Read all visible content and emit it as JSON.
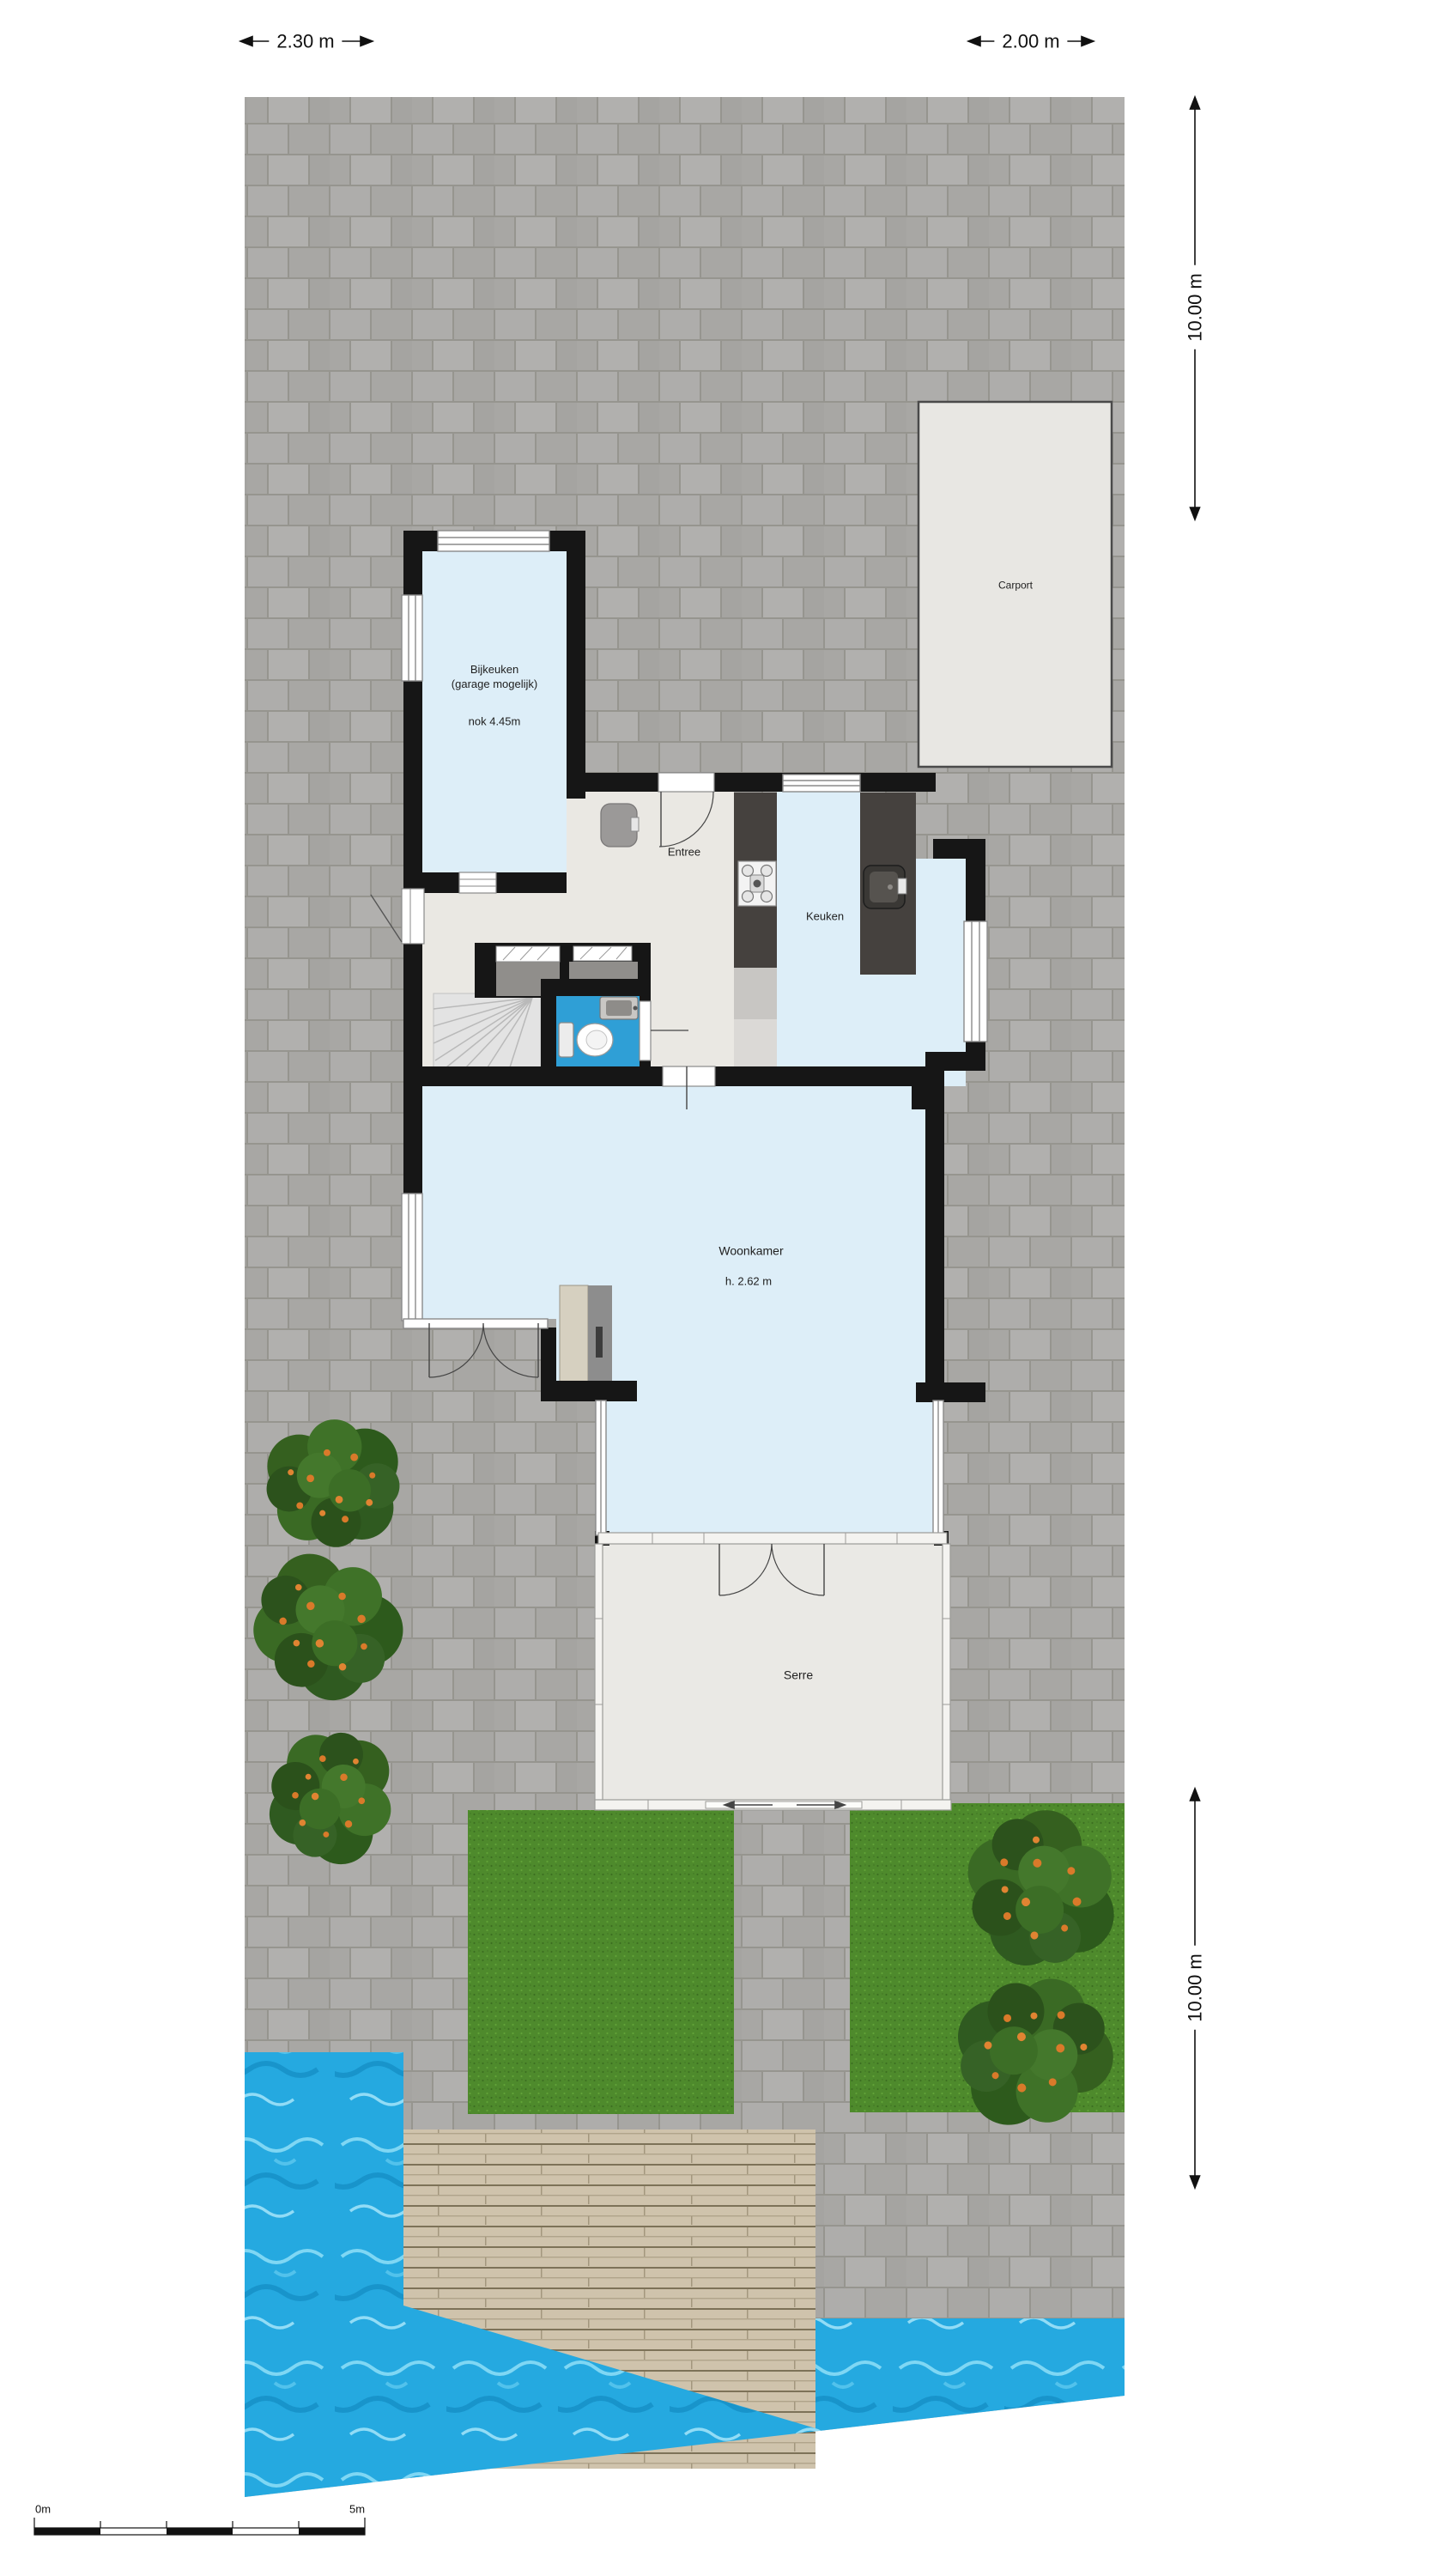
{
  "dimensions": {
    "top_left": "2.30 m",
    "top_right": "2.00 m",
    "right_upper": "10.00 m",
    "right_lower": "10.00 m"
  },
  "scale_bar": {
    "start_label": "0m",
    "end_label": "5m"
  },
  "rooms": {
    "bijkeuken_line1": "Bijkeuken",
    "bijkeuken_line2": "(garage mogelijk)",
    "bijkeuken_nok": "nok 4.45m",
    "entree": "Entree",
    "keuken": "Keuken",
    "woonkamer": "Woonkamer",
    "woonkamer_height": "h. 2.62 m",
    "serre": "Serre",
    "carport": "Carport"
  },
  "colors": {
    "wall": "#161616",
    "room_floor_blue": "#ddeef8",
    "hall_floor": "#eae8e3",
    "serre_floor": "#eae9e5",
    "toilet_blue": "#2f9fd6",
    "counter_dark": "#45413e",
    "paving": "#aeadab",
    "grass": "#4e8a2c",
    "water": "#25a9e0",
    "deck": "#cfc3ac",
    "carport_fill": "#e8e7e3"
  }
}
